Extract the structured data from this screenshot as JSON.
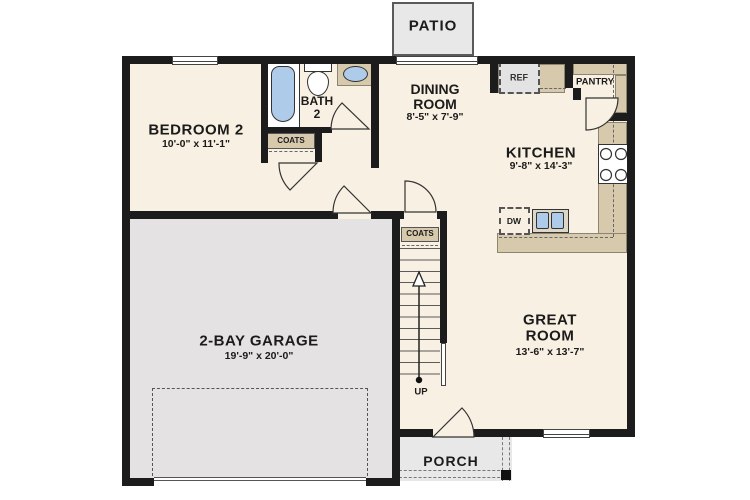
{
  "rooms": {
    "patio": {
      "label": "PATIO"
    },
    "bedroom2": {
      "name": "BEDROOM 2",
      "dims": "10'-0\" x 11'-1\""
    },
    "bath2": {
      "line1": "BATH",
      "line2": "2"
    },
    "dining": {
      "line1": "DINING",
      "line2": "ROOM",
      "dims": "8'-5\" x 7'-9\""
    },
    "kitchen": {
      "name": "KITCHEN",
      "dims": "9'-8\" x 14'-3\""
    },
    "great_room": {
      "line1": "GREAT",
      "line2": "ROOM",
      "dims": "13'-6\" x 13'-7\""
    },
    "garage": {
      "name": "2-BAY GARAGE",
      "dims": "19'-9\" x 20'-0\""
    },
    "porch": {
      "label": "PORCH"
    },
    "pantry": {
      "label": "PANTRY"
    }
  },
  "labels": {
    "refrigerator": "REF",
    "dishwasher": "DW",
    "coats_hall": "COATS",
    "coats_stairs": "COATS",
    "stairs_direction": "UP"
  },
  "colors": {
    "floor": "#F8F0E2",
    "garage_floor": "#E4E2E3",
    "wall": "#1C1C1C",
    "counter": "#D7C9AC",
    "fixture_blue": "#AECBE9",
    "concrete": "#E9E8E9"
  }
}
